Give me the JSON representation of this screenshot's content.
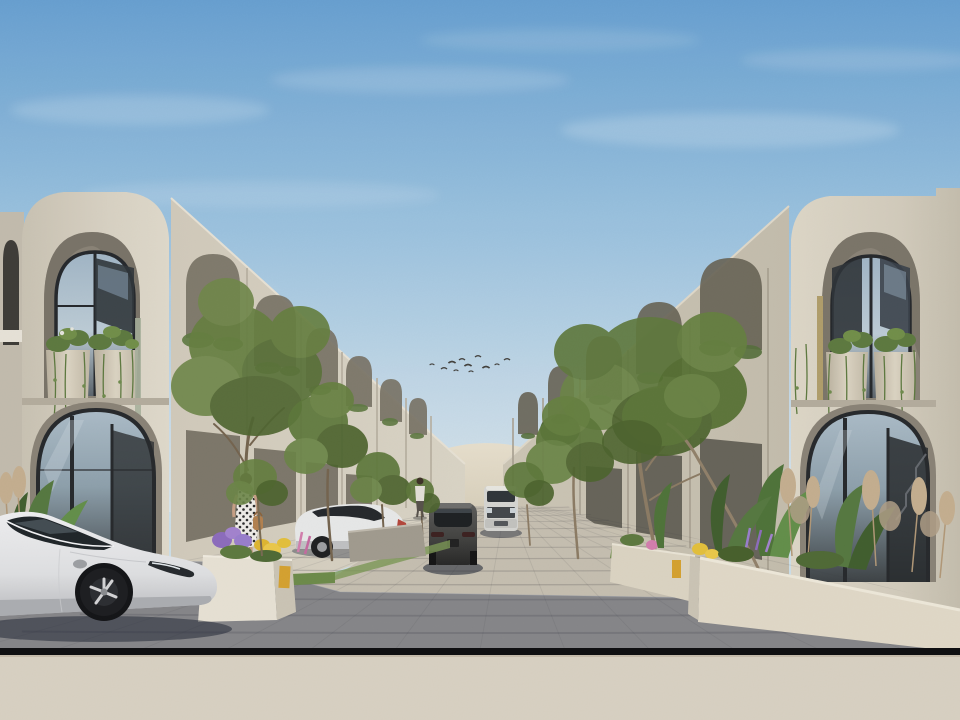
{
  "scene": {
    "type": "architectural-3d-render",
    "description": "Daytime 3D architectural rendering of a modern Mediterranean-style residential street. Two-storey cream stucco townhouses with tall arched openings line both sides of a brick-paved street that recedes to a sand dune on the horizon. Arched balconies hold round planters with trailing vines. A white electric sedan is parked in the shaded foreground at left, a white sedan is parked further up the left side, a dark grey car and a white SUV sit in the middle of the street. Slender green street trees, planters full of tropical plants, pampas grass and purple, yellow and pink flowers edge the street. A woman in a white polka-dot dress walks along the left sidewalk and a flock of small birds flies in the blue sky.",
    "time_of_day": "day",
    "weather": "clear"
  },
  "palette": {
    "sky_top": "#68a2d4",
    "sky_horizon": "#dce9f1",
    "building_light": "#ddd6c7",
    "building_side": "#cfc8b8",
    "building_row_right": "#c7c0af",
    "arch_recess": "#8b8477",
    "opening_dark": "#75705f",
    "glass_dark": "#33373b",
    "glass_sky": "#a3b8c9",
    "street_sun": "#c9c2b3",
    "street_shadow": "#2e3850",
    "foreground_strip": "#ddd5c6",
    "black_band": "#0b0b0d",
    "dune": "#e6decb",
    "green_mid": "#5d7839",
    "green_light": "#6b8646",
    "green_dark": "#4c642c",
    "trunk": "#7a6a52",
    "pampas": "#c8b191",
    "planter_white": "#ece6d8",
    "plaque_yellow": "#d9a42e",
    "flower_purple": "#9b7fd0",
    "flower_yellow": "#e8c33a",
    "flower_pink": "#d77fb0",
    "car_white": "#ededef",
    "car_dark": "#454543",
    "suv_white": "#d9d9d5"
  },
  "birds": {
    "count": 11,
    "points": [
      [
        432,
        365
      ],
      [
        444,
        369
      ],
      [
        452,
        363
      ],
      [
        456,
        371
      ],
      [
        462,
        360
      ],
      [
        468,
        366
      ],
      [
        471,
        372
      ],
      [
        478,
        357
      ],
      [
        486,
        368
      ],
      [
        497,
        365
      ],
      [
        507,
        360
      ]
    ]
  },
  "pavement": {
    "vanish_y": 506,
    "bottom_y": 650,
    "rows": 14,
    "row_exponent": 1.85,
    "left_top_x": 443,
    "right_top_x": 566,
    "left_bottom_x": -40,
    "right_bottom_x": 1000,
    "cols": 19,
    "col_spacing": 85,
    "joint_color": "rgba(70,70,75,0.22)",
    "fan_color": "rgba(60,60,65,0.10)"
  },
  "objects": {
    "vehicles": [
      {
        "id": "foreground-sedan",
        "label": "white electric sedan, side view, parked foreground left"
      },
      {
        "id": "parked-sedan",
        "label": "white sedan parked mid-left, facing left"
      },
      {
        "id": "street-car",
        "label": "dark grey car in street, rear view"
      },
      {
        "id": "street-suv",
        "label": "white SUV far up the street, front view"
      }
    ],
    "people": [
      {
        "id": "woman-polka-dot",
        "label": "woman in white polka-dot dress walking away"
      },
      {
        "id": "pedestrian",
        "label": "distant pedestrian near tree"
      }
    ],
    "street_trees": 8,
    "planters": 3,
    "address_plaques": 2
  }
}
